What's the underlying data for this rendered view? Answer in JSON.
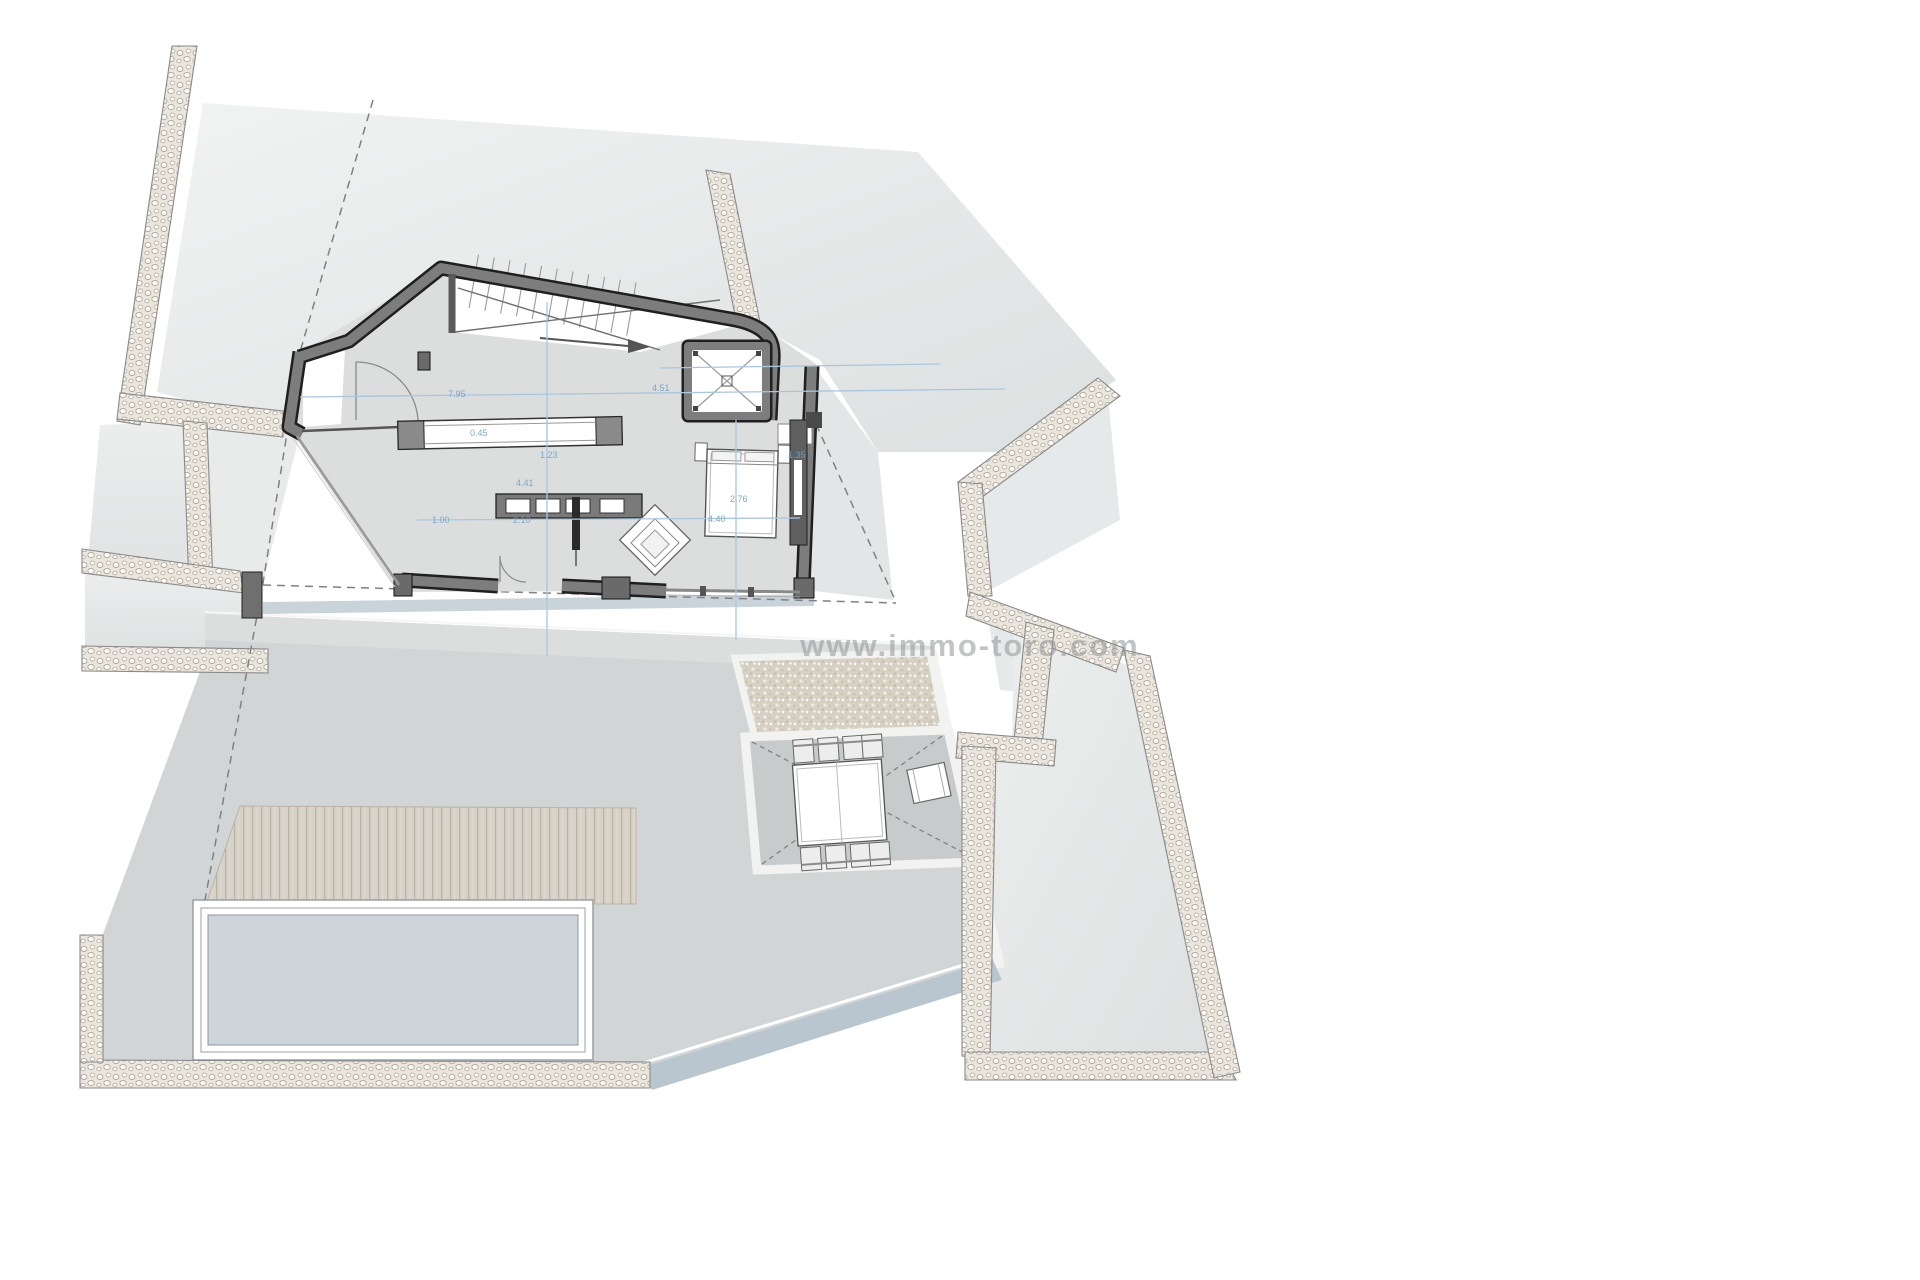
{
  "watermark": {
    "text": "www.immo-toro.com",
    "color": "#8f9698"
  },
  "dimensions": {
    "color": "#6fa3c8",
    "labels": [
      {
        "t": "7.95"
      },
      {
        "t": "4.51"
      },
      {
        "t": "1.23"
      },
      {
        "t": "0.45"
      },
      {
        "t": "4.41"
      },
      {
        "t": "1.00"
      },
      {
        "t": "2.10"
      },
      {
        "t": "4.40"
      },
      {
        "t": "2.76"
      },
      {
        "t": "1.35"
      }
    ]
  },
  "palette": {
    "background": "#ffffff",
    "neighbor_mass": "#e7eaea",
    "terrace": "#d2d5d6",
    "patio": "#c7cbcc",
    "floor": "#dcdddd",
    "wall_fill": "#7d7d7d",
    "wall_edge": "#1f1f1f",
    "pool_water": "#cdd5da",
    "deck_wood": "#d7d2c8",
    "gravel": "#d7d1c3",
    "pebble_wall": "#eae6dd",
    "dimension_blue": "#6fa3c8",
    "retaining_band": "#b9c6cf"
  }
}
